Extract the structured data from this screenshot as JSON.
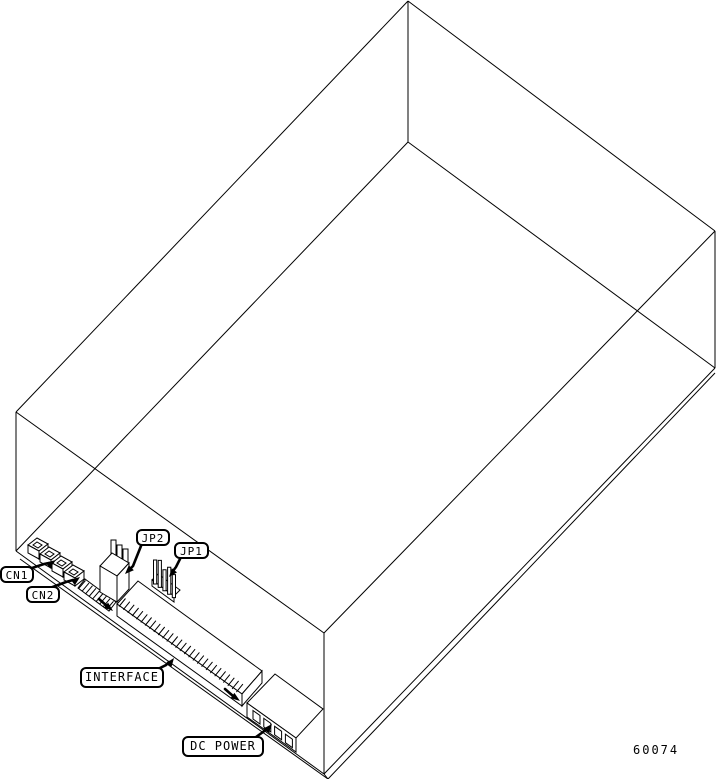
{
  "figure": {
    "number": "60074",
    "background_color": "#ffffff",
    "line_color": "#000000"
  },
  "callouts": [
    {
      "label": "CN1"
    },
    {
      "label": "CN2"
    },
    {
      "label": "JP2"
    },
    {
      "label": "JP1"
    },
    {
      "label": "INTERFACE"
    },
    {
      "label": "DC POWER"
    }
  ]
}
